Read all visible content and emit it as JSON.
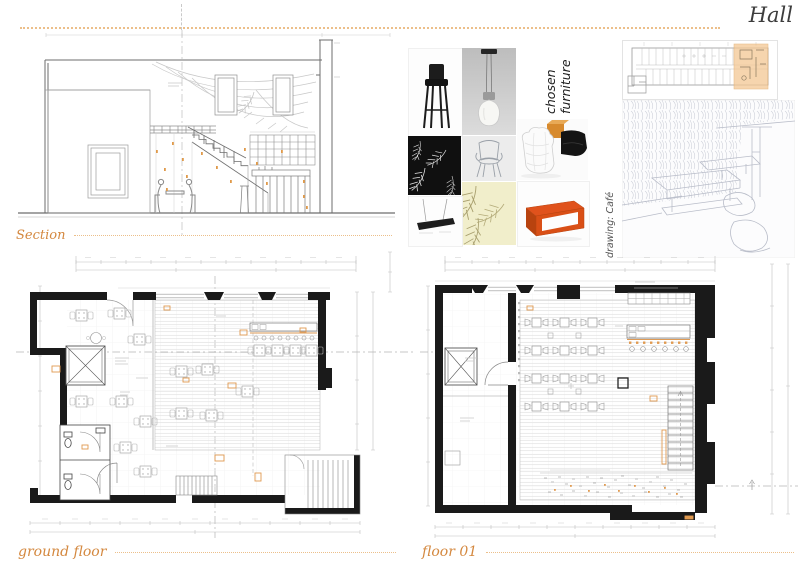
{
  "page": {
    "title": "Hall",
    "background": "#ffffff",
    "accent_color": "#d4883f",
    "dotted_rule_color": "#ecbf8a",
    "wall_color": "#1a1a1a",
    "drawing_line_color": "#9b9b9b",
    "keyplan_highlight_fill": "#f4c893"
  },
  "panels": {
    "section": {
      "label": "Section",
      "type": "architectural-section-drawing"
    },
    "moodboard": {
      "label": "chosen furniture",
      "tiles": [
        {
          "name": "bar-stool-photo"
        },
        {
          "name": "pendant-bulb-lamp-photo"
        },
        {
          "name": "label-tile"
        },
        {
          "name": "quilted-armchair-orange-box-black-sofa-photo"
        },
        {
          "name": "black-feather-pattern"
        },
        {
          "name": "ghost-chair-sketch"
        },
        {
          "name": "cream-feather-wallpaper"
        },
        {
          "name": "linear-pendant-light-photo"
        },
        {
          "name": "orange-coffee-table-photo"
        }
      ]
    },
    "keyplan": {
      "type": "building-key-plan-with-highlight"
    },
    "sketch": {
      "label": "drawing: Café",
      "type": "pencil-perspective-sketch"
    },
    "ground_floor": {
      "label": "ground floor",
      "type": "floor-plan"
    },
    "floor_01": {
      "label": "floor 01",
      "type": "floor-plan"
    }
  }
}
